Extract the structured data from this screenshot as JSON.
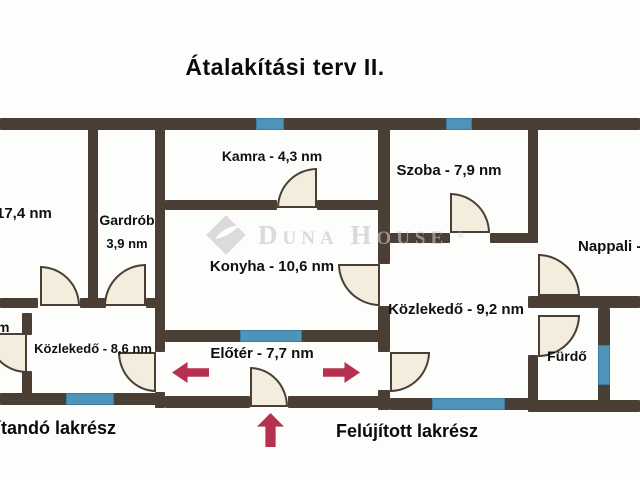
{
  "title": "Átalakítási terv II.",
  "rooms": {
    "left": {
      "label": "17,4 nm"
    },
    "gardrob": {
      "name": "Gardrób",
      "area": "3,9 nm"
    },
    "kamra": {
      "label": "Kamra - 4,3 nm"
    },
    "szoba": {
      "label": "Szoba - 7,9 nm"
    },
    "nappali": {
      "label": "Nappali -"
    },
    "konyha": {
      "label": "Konyha - 10,6 nm"
    },
    "hall_old": {
      "label": "Közlekedő - 8,6 nm"
    },
    "hall_new": {
      "label": "Közlekedő - 9,2 nm"
    },
    "eloter": {
      "label": "Előtér - 7,7 nm"
    },
    "furdo": {
      "label": "Fürdő"
    },
    "cut_room": {
      "label": "m"
    }
  },
  "captions": {
    "left": "ítandó lakrész",
    "right": "Felújított lakrész"
  },
  "watermark": {
    "brand": "Duna House",
    "registered": "®"
  },
  "colors": {
    "wall": "#4a3e35",
    "window": "#5093b8",
    "windowBorder": "#3a7da1",
    "door": "#f3edde",
    "arrow": "#b5314f",
    "label": "#101010",
    "watermark": "#c7c4c4"
  }
}
